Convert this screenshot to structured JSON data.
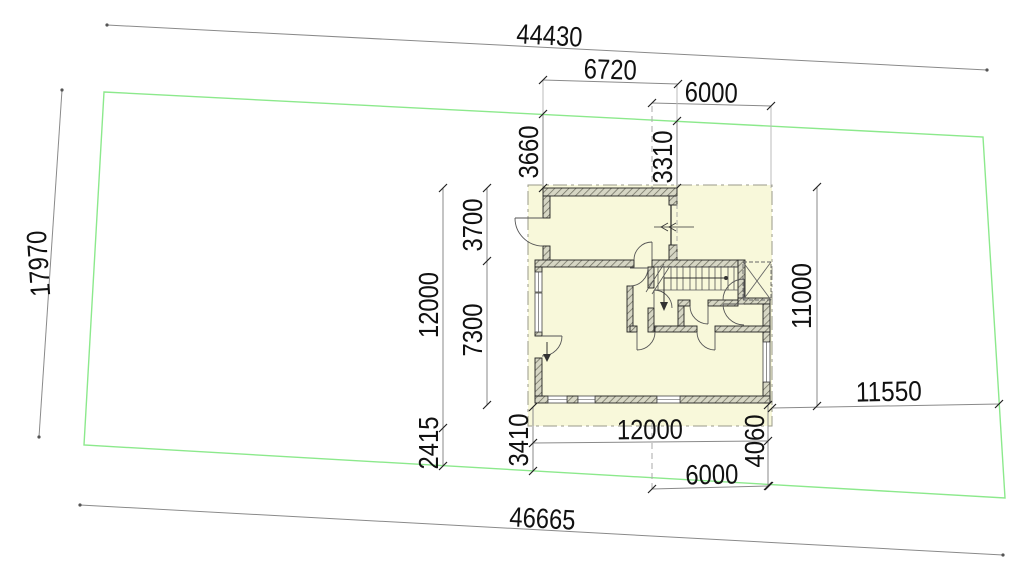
{
  "drawing": {
    "type": "architectural-site-plan",
    "colors": {
      "boundary": "#8ce98c",
      "building_fill": "#f8f8da",
      "dimension_line": "#8a8a8a",
      "text": "#111111"
    },
    "dims": {
      "site_top": "44430",
      "site_bottom": "46665",
      "site_left": "17970",
      "offset_top_small": "6720",
      "width_top_wing": "6000",
      "setback_top_left": "3660",
      "setback_top_right": "3310",
      "depth_front": "3700",
      "depth_rear": "7300",
      "depth_total_left": "12000",
      "depth_total_right": "11000",
      "setback_bottom_left": "2415",
      "setback_bottom_mid": "3410",
      "width_bottom": "12000",
      "width_bottom_wing": "6000",
      "setback_bottom_right": "4060",
      "setback_right": "11550"
    }
  }
}
